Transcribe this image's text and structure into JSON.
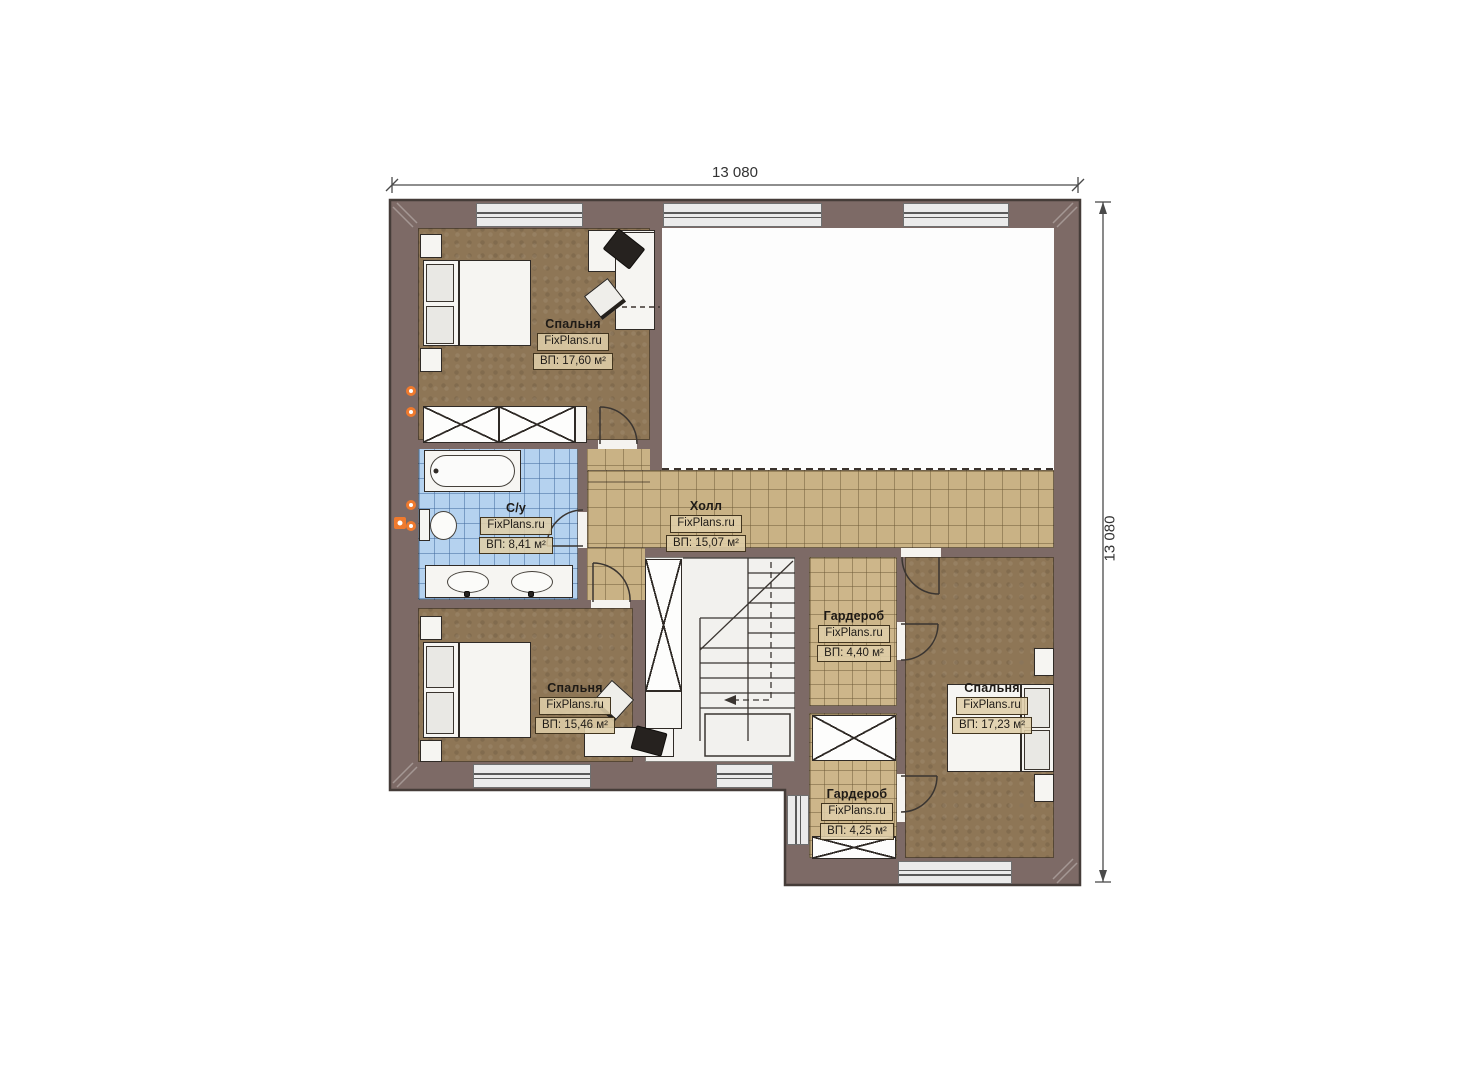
{
  "page": {
    "background": "#ffffff"
  },
  "dimensions": {
    "top": "13 080",
    "right": "13 080"
  },
  "brand_site": "FixPlans.ru",
  "colors": {
    "wall": "#7d6a66",
    "floor_wood": "#8e7656",
    "tile_tan": "#c9b285",
    "tile_blue": "#b5d2ef",
    "radiator_accent": "#ef7a2e"
  },
  "rooms": [
    {
      "key": "bedroom_top_left",
      "name": "Спальня",
      "area_label": "ВП: 17,60 м²"
    },
    {
      "key": "bathroom",
      "name": "С/у",
      "area_label": "ВП: 8,41 м²"
    },
    {
      "key": "hall",
      "name": "Холл",
      "area_label": "ВП: 15,07 м²"
    },
    {
      "key": "bedroom_bottom_left",
      "name": "Спальня",
      "area_label": "ВП: 15,46 м²"
    },
    {
      "key": "wardrobe_upper",
      "name": "Гардероб",
      "area_label": "ВП: 4,40 м²"
    },
    {
      "key": "bedroom_right",
      "name": "Спальня",
      "area_label": "ВП: 17,23 м²"
    },
    {
      "key": "wardrobe_lower",
      "name": "Гардероб",
      "area_label": "ВП: 4,25 м²"
    }
  ]
}
